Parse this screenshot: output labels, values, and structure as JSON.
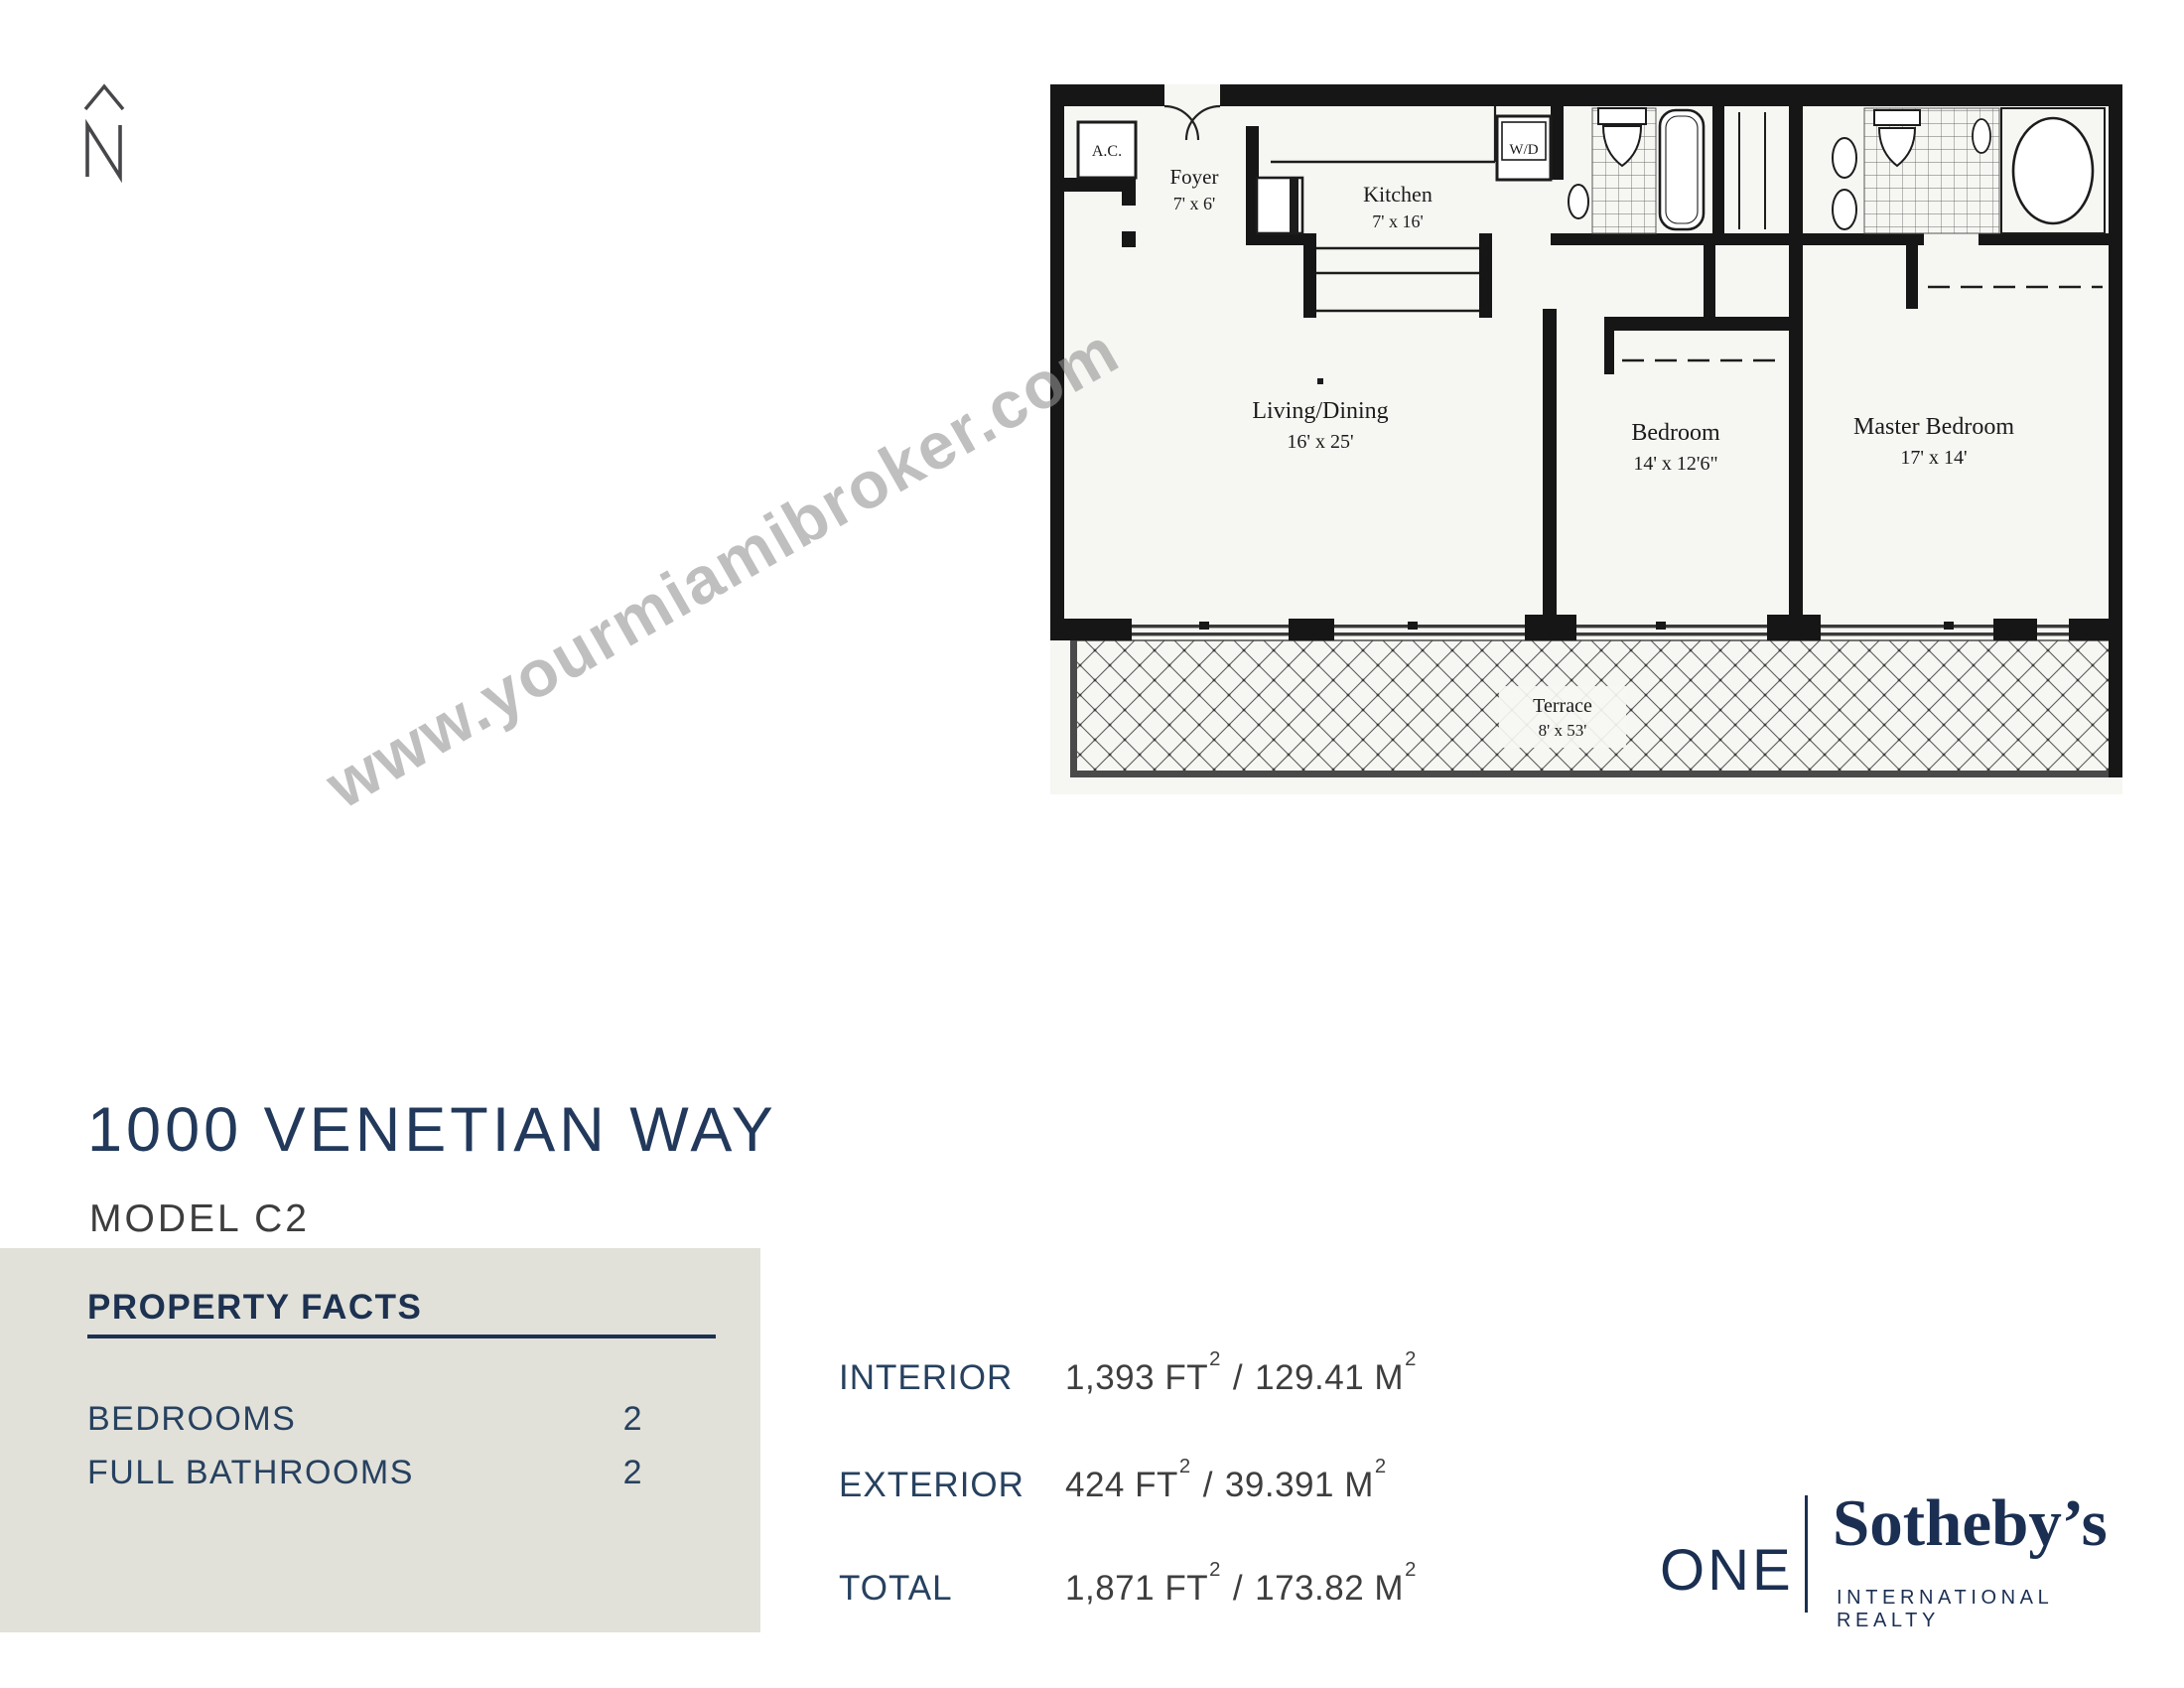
{
  "north_indicator": {
    "letter": "N"
  },
  "watermark": {
    "text": "www.yourmiamibroker.com"
  },
  "listing": {
    "title": "1000 VENETIAN WAY",
    "model": "MODEL C2"
  },
  "property_facts": {
    "heading": "PROPERTY FACTS",
    "rows": [
      {
        "label": "BEDROOMS",
        "value": "2"
      },
      {
        "label": "FULL BATHROOMS",
        "value": "2"
      }
    ]
  },
  "measurements": [
    {
      "label": "INTERIOR",
      "ft": "1,393",
      "ft_unit": "FT",
      "sup": "2",
      "sep": "/",
      "m": "129.41",
      "m_unit": "M"
    },
    {
      "label": "EXTERIOR",
      "ft": "424",
      "ft_unit": "FT",
      "sup": "2",
      "sep": "/",
      "m": "39.391",
      "m_unit": "M"
    },
    {
      "label": "TOTAL",
      "ft": "1,871",
      "ft_unit": "FT",
      "sup": "2",
      "sep": "/",
      "m": "173.82",
      "m_unit": "M"
    }
  ],
  "brand": {
    "one": "ONE",
    "name": "Sotheby’s",
    "tagline": "INTERNATIONAL REALTY"
  },
  "floor_plan": {
    "ac_label": "A.C.",
    "foyer": "Foyer",
    "foyer_dim": "7' x 6'",
    "kitchen": "Kitchen",
    "kitchen_dim": "7' x 16'",
    "wd_label": "W/D",
    "living": "Living/Dining",
    "living_dim": "16' x 25'",
    "bedroom": "Bedroom",
    "bedroom_dim": "14' x 12'6\"",
    "master": "Master Bedroom",
    "master_dim": "17' x 14'",
    "terrace": "Terrace",
    "terrace_dim": "8' x 53'"
  }
}
